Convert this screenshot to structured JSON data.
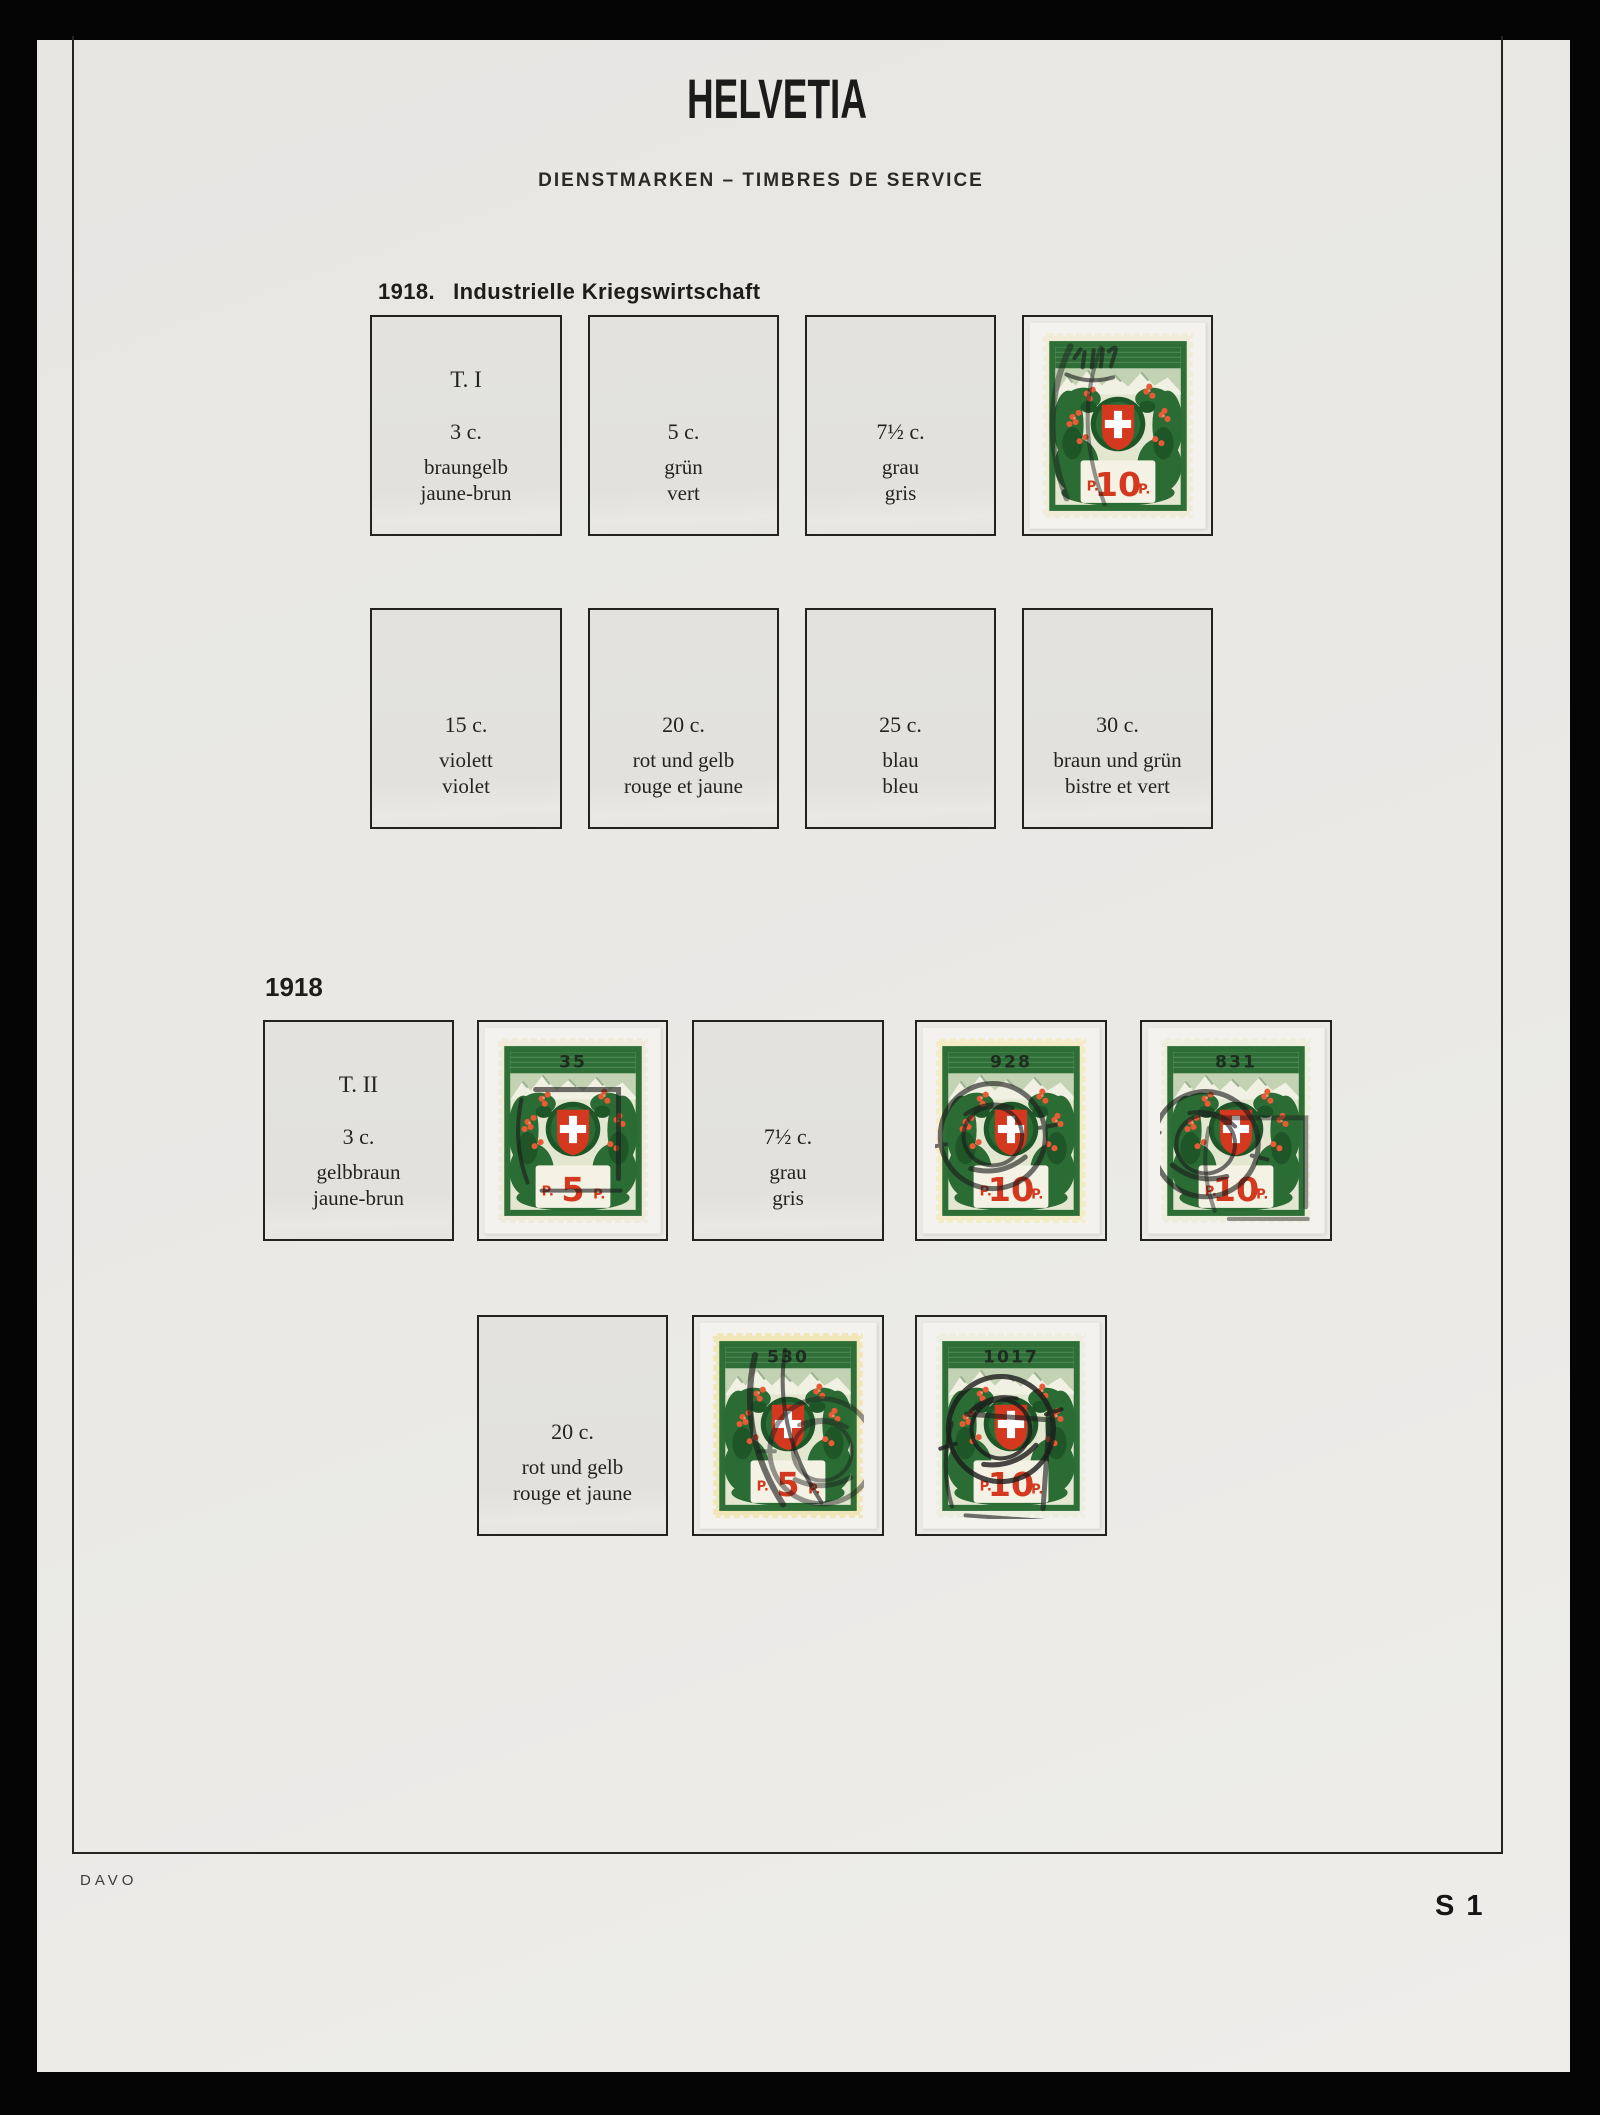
{
  "photo": {
    "background": "#050505",
    "page_color": "#e9e8e5"
  },
  "header": {
    "title": "HELVETIA",
    "subtitle": "DIENSTMARKEN – TIMBRES DE SERVICE"
  },
  "sections": {
    "first": {
      "year": "1918.",
      "name": "Industrielle Kriegswirtschaft"
    },
    "second": {
      "year": "1918"
    }
  },
  "footer": {
    "publisher": "DAVO",
    "page_code": "S 1"
  },
  "colors": {
    "stamp_green": "#2d6f36",
    "stamp_dark_green": "#1e5628",
    "stamp_red": "#d4381f",
    "paper_cream": "#f1edd9",
    "paper_yellow": "#f1e6ba",
    "mount": "#f3f2ee",
    "box_fill": "#e3e2de",
    "frame_line": "#26261f"
  },
  "boxes": {
    "t1_3c": {
      "type_line": "T. I",
      "value": "3 c.",
      "color_de": "braungelb",
      "color_fr": "jaune-brun"
    },
    "c5": {
      "value": "5 c.",
      "color_de": "grün",
      "color_fr": "vert"
    },
    "c7_1": {
      "value": "7½ c.",
      "color_de": "grau",
      "color_fr": "gris"
    },
    "c15": {
      "value": "15 c.",
      "color_de": "violett",
      "color_fr": "violet"
    },
    "c20_1": {
      "value": "20 c.",
      "color_de": "rot und gelb",
      "color_fr": "rouge et jaune"
    },
    "c25": {
      "value": "25 c.",
      "color_de": "blau",
      "color_fr": "bleu"
    },
    "c30": {
      "value": "30 c.",
      "color_de": "braun und grün",
      "color_fr": "bistre et vert"
    },
    "t2_3c": {
      "type_line": "T. II",
      "value": "3 c.",
      "color_de": "gelbbraun",
      "color_fr": "jaune-brun"
    },
    "c7_2": {
      "value": "7½ c.",
      "color_de": "grau",
      "color_fr": "gris"
    },
    "c20_2": {
      "value": "20 c.",
      "color_de": "rot und gelb",
      "color_fr": "rouge et jaune"
    }
  },
  "stamps": {
    "r1_10": {
      "control": "",
      "value_prefix": "P.",
      "value": "10",
      "value_suffix": "P."
    },
    "s35": {
      "control": "35",
      "value_prefix": "P.",
      "value": "5",
      "value_suffix": "P."
    },
    "s928": {
      "control": "928",
      "value_prefix": "P.",
      "value": "10",
      "value_suffix": "P."
    },
    "s831": {
      "control": "831",
      "value_prefix": "P.",
      "value": "10",
      "value_suffix": "P."
    },
    "s530": {
      "control": "530",
      "value_prefix": "P.",
      "value": "5",
      "value_suffix": "P."
    },
    "s1017": {
      "control": "1017",
      "value_prefix": "P.",
      "value": "10",
      "value_suffix": "P."
    }
  }
}
